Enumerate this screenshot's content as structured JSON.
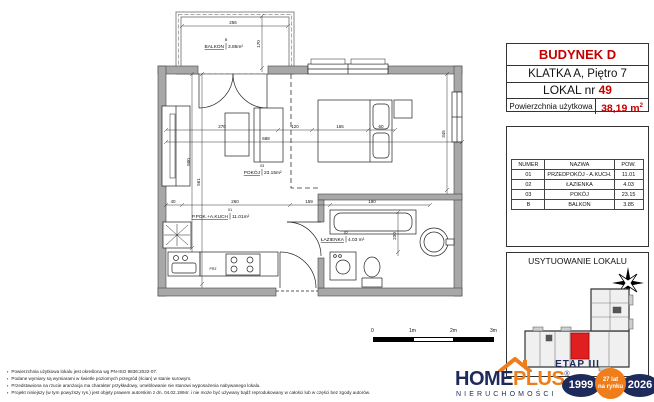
{
  "info_panel": {
    "building": "BUDYNEK D",
    "staircase": "KLATKA A, Piętro 7",
    "unit_label": "LOKAL nr ",
    "unit_number": "49",
    "area_label": "Powierzchnia użytkowa",
    "area_value": "38,19 m",
    "area_sup": "2"
  },
  "rooms_table": {
    "headers": [
      "NUMER",
      "NAZWA",
      "POW."
    ],
    "rows": [
      {
        "num": "01",
        "name": "PRZEDPOKÓJ - A.KUCH.",
        "area": "11.01"
      },
      {
        "num": "02",
        "name": "ŁAZIENKA",
        "area": "4.03"
      },
      {
        "num": "03",
        "name": "POKÓJ",
        "area": "23.15"
      },
      {
        "num": "B",
        "name": "BALKON",
        "area": "3.85"
      }
    ]
  },
  "location_box": {
    "title": "USYTUOWANIE LOKALU",
    "stage": "ETAP III"
  },
  "plan": {
    "labels": {
      "balcony": {
        "num": "B",
        "name": "BALKON",
        "area": "3.85m²"
      },
      "room": {
        "num": "03",
        "name": "POKÓJ",
        "area": "23.15m²"
      },
      "hall": {
        "num": "01",
        "name": "P.POK.+A.KUCH",
        "area": "11.01m²"
      },
      "bath": {
        "num": "02",
        "name": "ŁAZIENKA",
        "area": "4.03 m²"
      },
      "stove": "PRZ"
    },
    "dims": {
      "balcony_w": "256",
      "balcony_d": "170",
      "d270": "270",
      "d120": "120",
      "d165": "165",
      "d60": "60",
      "total": "688",
      "left1": "500",
      "left2": "561",
      "right": "345",
      "f40": "40",
      "f260": "260",
      "f159": "159",
      "f190": "190",
      "bath": "230"
    }
  },
  "scale_bar": {
    "t0": "0",
    "t1": "1m",
    "t2": "2m",
    "t3": "3m"
  },
  "disclaimers": [
    "Powierzchnia użytkowa lokalu jest określona wg PN-ISO 9836:2022-07.",
    "Podane wymiary są wymiarami w świetle poziomych przegród (ścian) w stanie surowym.",
    "Przedstawiona na rzucie aranżacja ma charakter przykładowy, umeblowanie nie stanowi wyposażenia nabywanego lokalu.",
    "Projekt niniejszy (w tym powyższy rys.) jest objęty prawem autorskim z dn. 04.02.1994r. i nie może być używany bądź reprodukowany w całości lub w części bez zgody autorów."
  ],
  "logo": {
    "home": "HOME",
    "plus": "PLUS",
    "reg": "®",
    "sub": "NIERUCHOMOŚCI",
    "year_start": "1999",
    "year_end": "2026",
    "badge_line1": "27 lat",
    "badge_line2": "na rynku"
  }
}
